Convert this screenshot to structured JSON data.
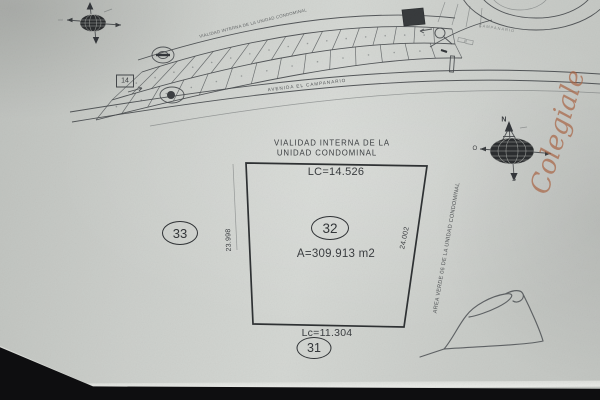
{
  "colors": {
    "paper": "#cdd0cc",
    "ink": "#3a3d40",
    "handwriting_orange": "#ab6848",
    "background": "#0e0e10"
  },
  "site_map": {
    "road_top_label": "VIALIDAD INTERNA DE LA UNIDAD CONDOMINAL",
    "avenue_label": "AVENIDA EL CAMPANARIO",
    "roundabout_label": "CAMPANARIO",
    "block_number": "14"
  },
  "lot_plan": {
    "street_line1": "VIALIDAD INTERNA DE LA",
    "street_line2": "UNIDAD CONDOMINAL",
    "front_arc": "LC=14.526",
    "rear_arc": "Lc=11.304",
    "left_side": "23.998",
    "right_side": "24.002",
    "lot_number": "32",
    "area": "A=309.913 m2",
    "neighbor_left": "33",
    "neighbor_rear": "31",
    "green_area_label": "AREA VERDE 06 DE LA UNIDAD CONDOMINAL"
  },
  "compass": {
    "north": "N",
    "west": "O",
    "south": "S"
  },
  "annotations": {
    "handwriting": "Colegiale"
  }
}
